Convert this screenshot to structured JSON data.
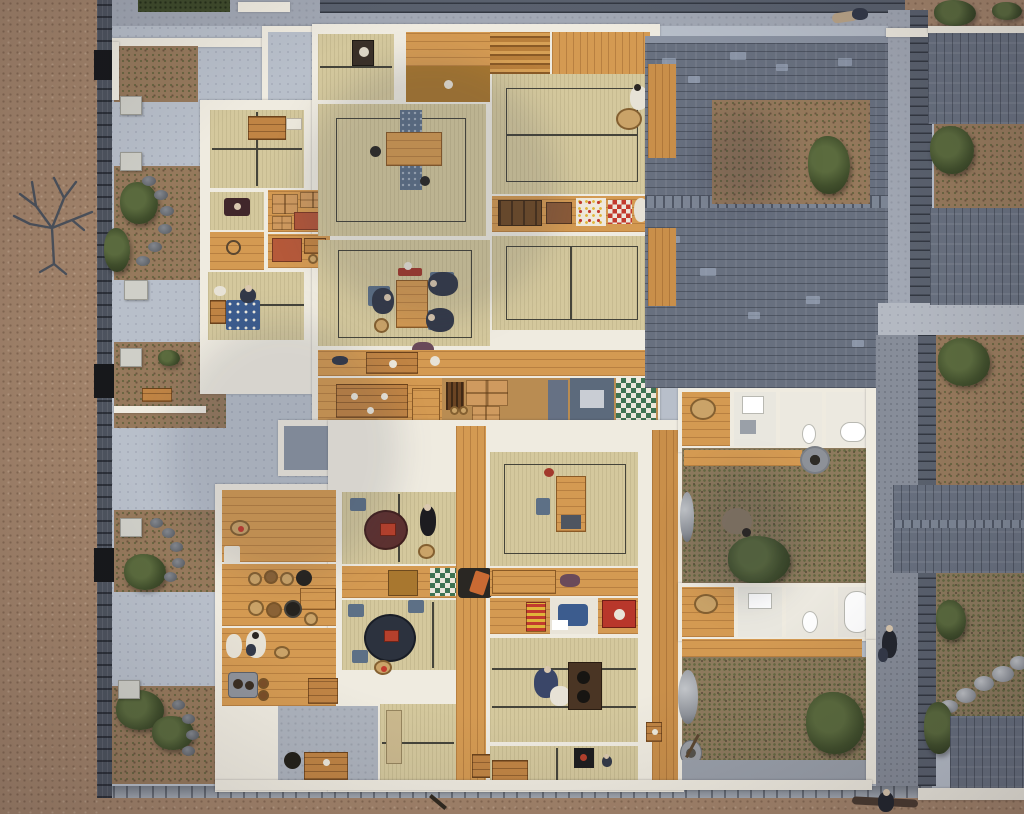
{
  "meta": {
    "title": "Overhead photograph of a museum diorama: cutaway scale model of Edo-period Japanese row houses (nagaya) with open-top tatami interiors, miniature figures, tiled roofs, walled gardens and streets",
    "description": "Bird's-eye view of an architectural miniature. Left: earthen street, dark stone boundary wall and plastered courtyard with small walled garden pockets and a bare tree. Centre: two cutaway dwellings showing tatami rooms, kitchens, stairs, chests, bedding and tiny human figures. Right: blue-grey tiled roofs of neighbouring houses, rear courtyards with a well and stepping stones, and a back alley.",
    "visible_text": "none"
  },
  "palette": {
    "dirt": "#a3846b",
    "garden": "#96795c",
    "concrete": "#b8bfca",
    "doma": "#adb3bd",
    "roof": "#68707f",
    "roofLight": "#99a3b4",
    "stoneWall": "#4d535e",
    "post": "#17181b",
    "wallWhite": "#efebe0",
    "tatami": "#d4c89d",
    "seam": "#45443a",
    "wood": "#d49a52",
    "woodDark": "#a8772f",
    "chest": "#c08444",
    "bushGreen": "#44522e",
    "stoneGray": "#989ca3",
    "navy": "#2c323e",
    "maroon": "#5d3130",
    "futonBlue": "#3c5c8e",
    "futonGreen": "#3f7352",
    "red": "#c23b2e",
    "yellow": "#e0b53a",
    "slate": "#5d7086",
    "white": "#ece8dc",
    "figDark": "#333948",
    "figBlue": "#3a4668",
    "skin": "#d9c7ae"
  },
  "inventory": {
    "figures": [
      "three seated figures around the dining table in the upper house",
      "figure in white kimono with round tray at the veranda edge",
      "figure at a loom in the left-wing room",
      "small figure beside a polka-dot futon",
      "standing figure by the round table",
      "cook in white at the kitchen sink",
      "seated figure wrapped in a quilt at the charcoal brazier",
      "crouching figure in the rear courtyard",
      "figure walking along the right-hand alley",
      "figure resting on the top street",
      "small figure near the bottom street"
    ],
    "objects": [
      "low wooden dining table on a patterned blue runner",
      "round lacquered tables with trays and dishes",
      "charcoal brazier (hibachi)",
      "tansu chests and wrapped parcels",
      "stacked and folded futon bedding (blue polka-dot, green check, red-white check, striped box)",
      "kitchen pots, bowls, water jars and clay stove (kamado)",
      "staircases and wooden verandas",
      "bath tubs, wash basins and squat toilets",
      "stone well and water bucket",
      "garden stones and stepping-stone path"
    ],
    "architecture": [
      "earthen street (left and bottom edges)",
      "dark stone boundary wall with gate posts",
      "plastered courtyard with zigzag garden walls and stone pillars",
      "five garden pockets with shrubs and stone edging",
      "bare winter tree",
      "two cutaway row-house blocks with tatami rooms",
      "blue-grey tiled roofs of neighbouring houses",
      "rear service courtyards",
      "back alley with tiled garden walls",
      "stone kerb along the bottom street"
    ]
  }
}
